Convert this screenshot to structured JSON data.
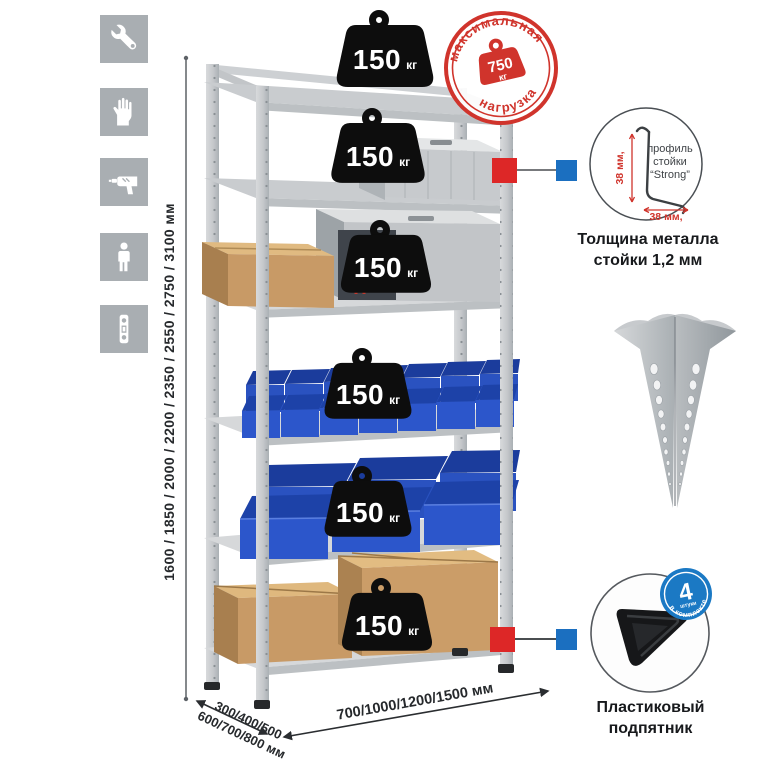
{
  "page": {
    "background": "#ffffff"
  },
  "sidebar": {
    "icons": [
      "wrench-icon",
      "gloves-icon",
      "drill-icon",
      "person-icon",
      "level-icon"
    ]
  },
  "dimensions": {
    "height": "1600 / 1850 / 2000 / 2200 / 2350 / 2550 / 2750 / 3100 мм",
    "depth_line1": "300/400/500",
    "depth_line2": "600/700/800 мм",
    "width": "700/1000/1200/1500 мм"
  },
  "shelves": [
    {
      "load": "150",
      "unit": "кг",
      "contents": "empty-top-shelf"
    },
    {
      "load": "150",
      "unit": "кг",
      "contents": "aluminum-case"
    },
    {
      "load": "150",
      "unit": "кг",
      "contents": "carton-and-metal-case"
    },
    {
      "load": "150",
      "unit": "кг",
      "contents": "small-blue-bins"
    },
    {
      "load": "150",
      "unit": "кг",
      "contents": "large-blue-bins"
    },
    {
      "load": "150",
      "unit": "кг",
      "contents": "cardboard-boxes"
    }
  ],
  "stamp": {
    "arc_top": "максимальная",
    "arc_bottom": "нагрузка",
    "value": "750",
    "unit": "кг",
    "color": "#d0342c"
  },
  "profile_callout": {
    "line1": "профиль",
    "line2": "стойки",
    "line3": "“Strong”",
    "dim_vertical": "38 мм,",
    "dim_horizontal": "38 мм,",
    "caption_line1": "Толщина металла",
    "caption_line2": "стойки 1,2 мм"
  },
  "foot_callout": {
    "caption_line1": "Пластиковый",
    "caption_line2": "подпятник",
    "badge_value": "4",
    "badge_sub": "штуки",
    "badge_arc": "в комплекте"
  },
  "colors": {
    "accent_red": "#d0342c",
    "accent_blue": "#1b72c0",
    "bin_blue": "#2c56cb",
    "metal": "#c9ccce",
    "carton": "#c89a66"
  }
}
